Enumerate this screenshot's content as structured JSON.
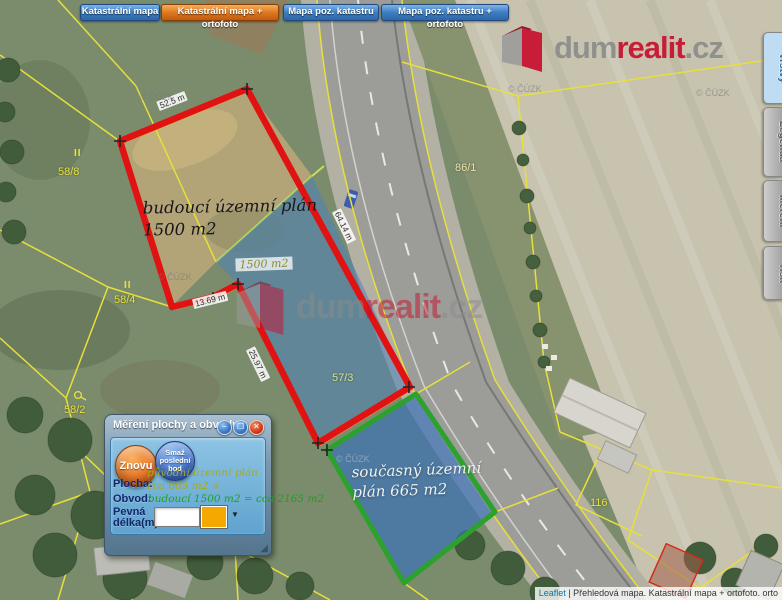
{
  "toolbar": {
    "buttons": [
      {
        "label": "Katastrální mapa",
        "active": false
      },
      {
        "label": "Katastrální mapa + ortofoto",
        "active": true
      },
      {
        "label": "Mapa poz. katastru",
        "active": false
      },
      {
        "label": "Mapa poz. katastru + ortofoto",
        "active": false
      }
    ]
  },
  "brand": {
    "dum": "dum",
    "realit": "realit",
    "tld": ".cz"
  },
  "side_tabs": {
    "items": [
      {
        "label": "Vrstvy",
        "active": true
      },
      {
        "label": "Legenda",
        "active": false
      },
      {
        "label": "Měření",
        "active": false
      },
      {
        "label": "Tisk",
        "active": false
      }
    ]
  },
  "map": {
    "copyright": "© ČÚZK",
    "parcels": [
      {
        "id": "58/8"
      },
      {
        "id": "58/4"
      },
      {
        "id": "58/2"
      },
      {
        "id": "86/1"
      },
      {
        "id": "57/3"
      },
      {
        "id": "116"
      }
    ],
    "culture_marks": [
      "II",
      "II"
    ],
    "annotations": {
      "future_line1": "budoucí územní plán",
      "future_line2": "1500 m2",
      "current_line1": "současný územní",
      "current_line2": "plán 665 m2"
    },
    "measurements": {
      "top_edge": "52.5 m",
      "road_edge": "64.14 m",
      "left_edge": "25.97 m",
      "bottom_edge": "13.69 m",
      "area_label": "1500 m2"
    }
  },
  "dialog": {
    "title": "Měření plochy a obvodu",
    "window_buttons": {
      "minimize": "−",
      "restore": "❐",
      "close": "✕"
    },
    "buttons": {
      "reset": "Znovu",
      "undo": "Smaž poslední bod"
    },
    "fields": {
      "area": "Plocha:",
      "perimeter": "Obvod:",
      "fixed1": "Pevná",
      "fixed2": "délka(m):",
      "input_value": ""
    },
    "notes": {
      "line1": "původní územní plán",
      "line2": "cca 665 m2 +",
      "line3": "budoucí 1500 m2 = cca 2165 m2"
    },
    "swatch_color": "#f5a800",
    "icons": {
      "dropdown_arrow": "▼",
      "resize_grip": "◢"
    }
  },
  "attribution": {
    "link": "Leaflet",
    "text": " | Přehledová mapa. Katastrální mapa + ortofoto. orto"
  }
}
